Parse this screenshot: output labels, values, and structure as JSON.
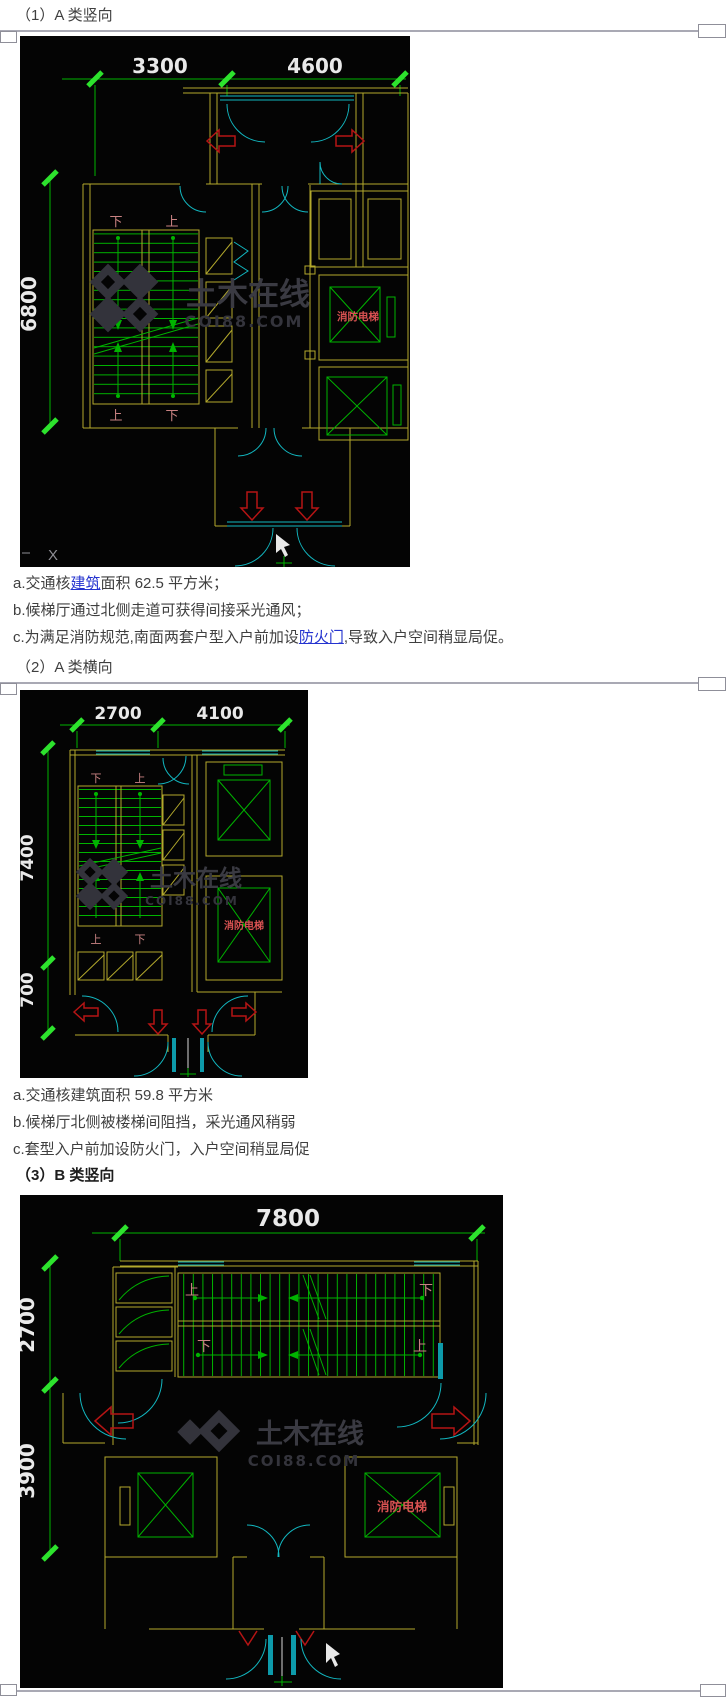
{
  "headings": {
    "h1": "（1）A 类竖向",
    "h2": "（2）A 类横向",
    "h3": "（3）B 类竖向"
  },
  "notes1": {
    "a_pre": "a.交通核",
    "a_link": "建筑",
    "a_post": "面积 62.5 平方米；",
    "b": "b.候梯厅通过北侧走道可获得间接采光通风；",
    "c_pre": "c.为满足消防规范,南面两套户型入户前加设",
    "c_link": "防火门",
    "c_post": ",导致入户空间稍显局促。"
  },
  "notes2": {
    "a": "a.交通核建筑面积 59.8 平方米",
    "b": "b.候梯厅北侧被楼梯间阻挡，采光通风稍弱",
    "c": "c.套型入户前加设防火门，入户空间稍显局促"
  },
  "watermark": {
    "cn": "土木在线",
    "en": "COI88.COM"
  },
  "plan1": {
    "dims": {
      "top_left": "3300",
      "top_right": "4600",
      "left": "6800"
    },
    "stair": {
      "tl": "下",
      "tr": "上",
      "bl": "上",
      "br": "下"
    },
    "elevator": "消防电梯",
    "artifact": "X"
  },
  "plan2": {
    "dims": {
      "top_left": "2700",
      "top_right": "4100",
      "left": "7400",
      "left_bottom": "700"
    },
    "stair": {
      "tl": "下",
      "tr": "上",
      "bl": "上",
      "br": "下"
    },
    "elevator": "消防电梯"
  },
  "plan3": {
    "dims": {
      "top": "7800",
      "left_top": "2700",
      "left_bottom": "3900"
    },
    "stair": {
      "tl": "上",
      "tr": "下",
      "bl": "下",
      "br": "上"
    },
    "elevator": "消防电梯"
  },
  "colors": {
    "link": "#2433cf",
    "cad_wall": "#b3a92c",
    "cad_green": "#00b300",
    "cad_cyan": "#12b7c0",
    "cad_red": "#b51414",
    "dim_text": "#e9e9e9"
  }
}
